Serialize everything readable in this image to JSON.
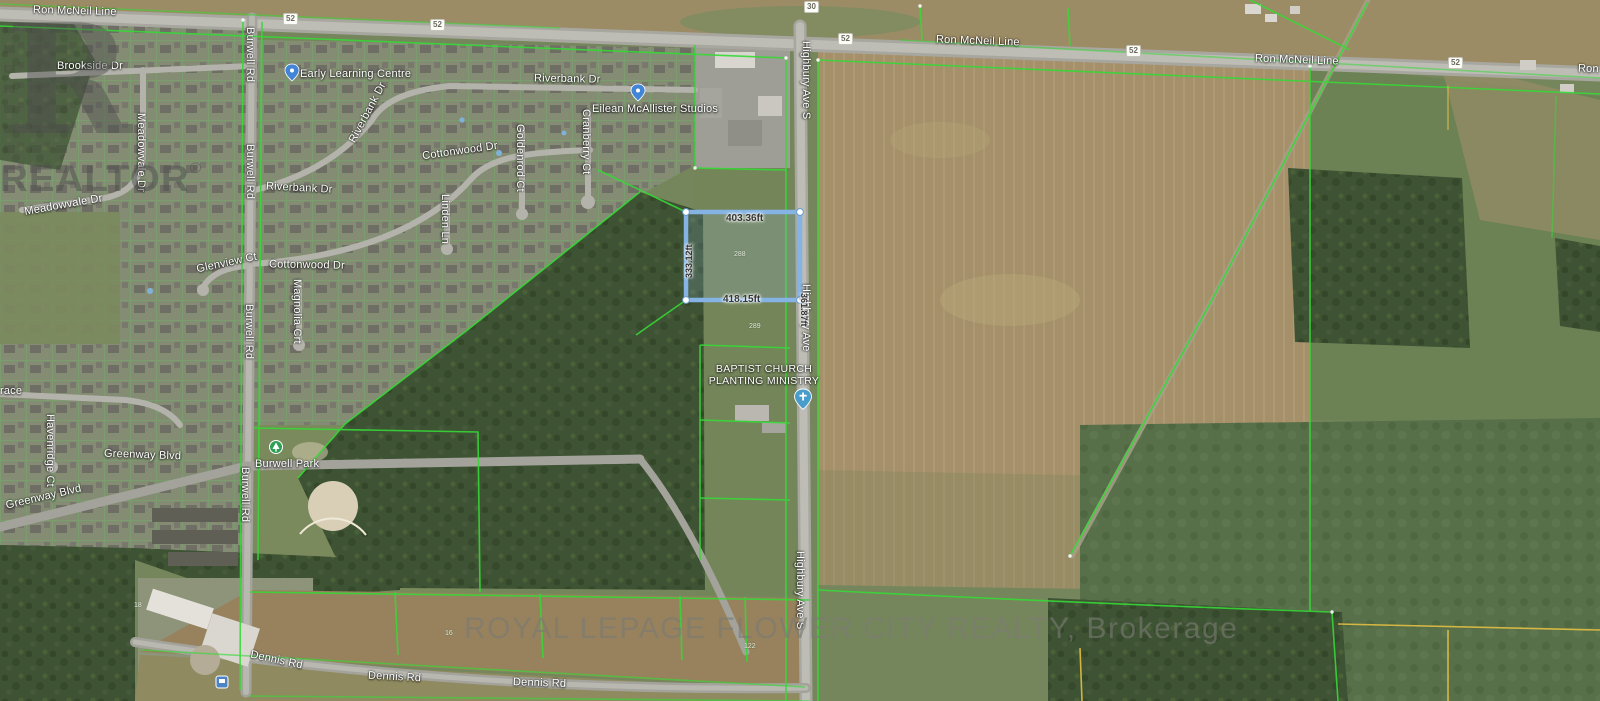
{
  "watermarks": {
    "logo_letter": "R",
    "realtor": "REALTOR",
    "reg": "®",
    "brokerage": "ROYAL LEPAGE FLOWER CITY REALTY, Brokerage"
  },
  "map": {
    "road_labels": [
      "Ron McNeil Line",
      "Ron McNeil Line",
      "Ron McNeil Line",
      "Ron McNeil Line",
      "Brookside Dr",
      "Meadowvale Dr",
      "Meadowvale Dr",
      "Burwell Rd",
      "Burwell Rd",
      "Burwell Rd",
      "Burwell Rd",
      "Riverbank Dr",
      "Riverbank Dr",
      "Riverbank Dr",
      "Cottonwood Dr",
      "Cottonwood Dr",
      "Goldenrod Ct",
      "Cranberry Ct",
      "Linden Ln",
      "Glenview Ct",
      "Magnolia Crt",
      "Havenridge Ct",
      "Greenway Blvd",
      "Greenway Blvd",
      "race",
      "Dennis Rd",
      "Dennis Rd",
      "Dennis Rd",
      "Highbury Ave S",
      "Highbury Ave",
      "Highbury Ave S"
    ],
    "route_shields": [
      "52",
      "52",
      "52",
      "52",
      "52",
      "30"
    ],
    "poi_labels": [
      "Early Learning Centre",
      "Eilean McAllister Studios",
      "Burwell Park"
    ],
    "church_label_lines": [
      "BAPTIST CHURCH",
      "PLANTING MINISTRY"
    ],
    "parcel_measurements": {
      "top": "403.36ft",
      "bottom": "418.15ft",
      "left": "333.12ft",
      "right": "361.87ft"
    },
    "lot_numbers": [
      "288",
      "289",
      "122",
      "16",
      "18"
    ],
    "colors": {
      "parcel_outline": "#85b4e4",
      "boundary_green": "#37d937",
      "boundary_yellow": "#e5c043",
      "road_label_text": "#ffffff"
    }
  }
}
